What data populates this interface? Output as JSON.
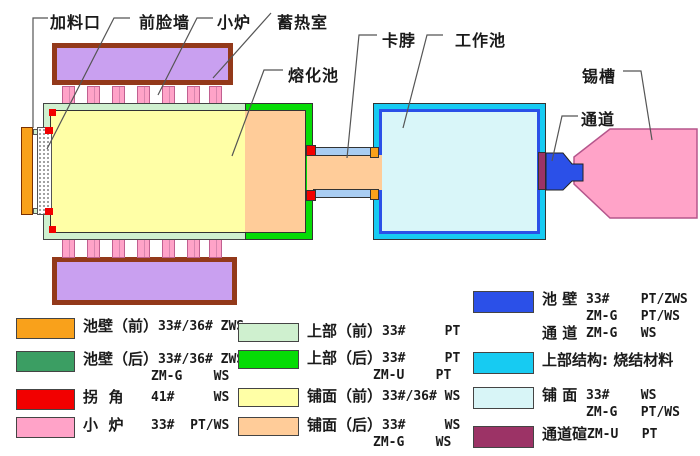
{
  "colors": {
    "wall_front_orange": "#F9A11B",
    "wall_rear_green": "#3B9E63",
    "corner_red": "#F20000",
    "furnace_pink": "#FFA3C8",
    "upper_front_mint": "#CFF0CF",
    "upper_rear_green": "#06DC06",
    "paving_front_yellow": "#FFFFA6",
    "paving_rear_peach": "#FFCC99",
    "pool_wall_blue": "#2B50E8",
    "upper_structure_cyan": "#17CBF2",
    "paving_pale_cyan": "#D8F5F7",
    "channel_arch_maroon": "#9C3366",
    "regenerator_purple": "#C9A0F0",
    "neck_wall_lightblue": "#A9CDF2",
    "working_pool_fill": "#D9F6F9",
    "tin_bath_pink": "#FFA3C8"
  },
  "diagram_labels": {
    "feed_port": "加料口",
    "front_face_wall": "前脸墙",
    "small_furnace": "小炉",
    "regenerator": "蓄热室",
    "melting_pool": "熔化池",
    "neck": "卡脖",
    "working_pool": "工作池",
    "tin_bath": "锡槽",
    "channel": "通道"
  },
  "legend": {
    "left": [
      {
        "key": "pool-wall-front",
        "color": "#F9A11B",
        "lines": [
          {
            "cn": "池壁（前）",
            "spec": "33#/36# ZWS"
          }
        ]
      },
      {
        "key": "pool-wall-rear",
        "color": "#3B9E63",
        "lines": [
          {
            "cn": "池壁（后）",
            "spec": "33#/36# ZWS"
          },
          {
            "cn": "",
            "spec": "ZM-G    WS"
          }
        ]
      },
      {
        "key": "corner",
        "color": "#F20000",
        "lines": [
          {
            "cn": "拐  角",
            "spec": "41#     WS"
          }
        ]
      },
      {
        "key": "small-furnace",
        "color": "#FFA3C8",
        "lines": [
          {
            "cn": "小  炉",
            "spec": "33#  PT/WS"
          }
        ]
      }
    ],
    "middle": [
      {
        "key": "upper-front",
        "color": "#CFF0CF",
        "lines": [
          {
            "cn": "上部（前）",
            "spec": "33#     PT"
          }
        ]
      },
      {
        "key": "upper-rear",
        "color": "#06DC06",
        "lines": [
          {
            "cn": "上部（后）",
            "spec": "33#     PT"
          },
          {
            "cn": "",
            "spec": "ZM-U    PT"
          }
        ]
      },
      {
        "key": "paving-front",
        "color": "#FFFFA6",
        "lines": [
          {
            "cn": "铺面（前）",
            "spec": "33#/36# WS"
          }
        ]
      },
      {
        "key": "paving-rear",
        "color": "#FFCC99",
        "lines": [
          {
            "cn": "铺面（后）",
            "spec": "33#     WS"
          },
          {
            "cn": "",
            "spec": "ZM-G    WS"
          }
        ]
      }
    ],
    "right": [
      {
        "key": "pool-wall-channel",
        "color": "#2B50E8",
        "lines": [
          {
            "cn": "池 壁",
            "spec": "33#    PT/ZWS"
          },
          {
            "cn": "",
            "spec": "ZM-G   PT/WS"
          },
          {
            "cn": "通 道",
            "spec": "ZM-G   WS"
          }
        ]
      },
      {
        "key": "upper-structure",
        "color": "#17CBF2",
        "lines": [
          {
            "cn": "上部结构: 烧结材料",
            "spec": ""
          }
        ]
      },
      {
        "key": "paving",
        "color": "#D8F5F7",
        "lines": [
          {
            "cn": "铺 面",
            "spec": "33#    WS"
          },
          {
            "cn": "",
            "spec": "ZM-G   PT/WS"
          }
        ]
      },
      {
        "key": "channel-arch",
        "color": "#9C3366",
        "lines": [
          {
            "cn": "通道碹",
            "spec": "ZM-U   PT"
          }
        ]
      }
    ]
  }
}
